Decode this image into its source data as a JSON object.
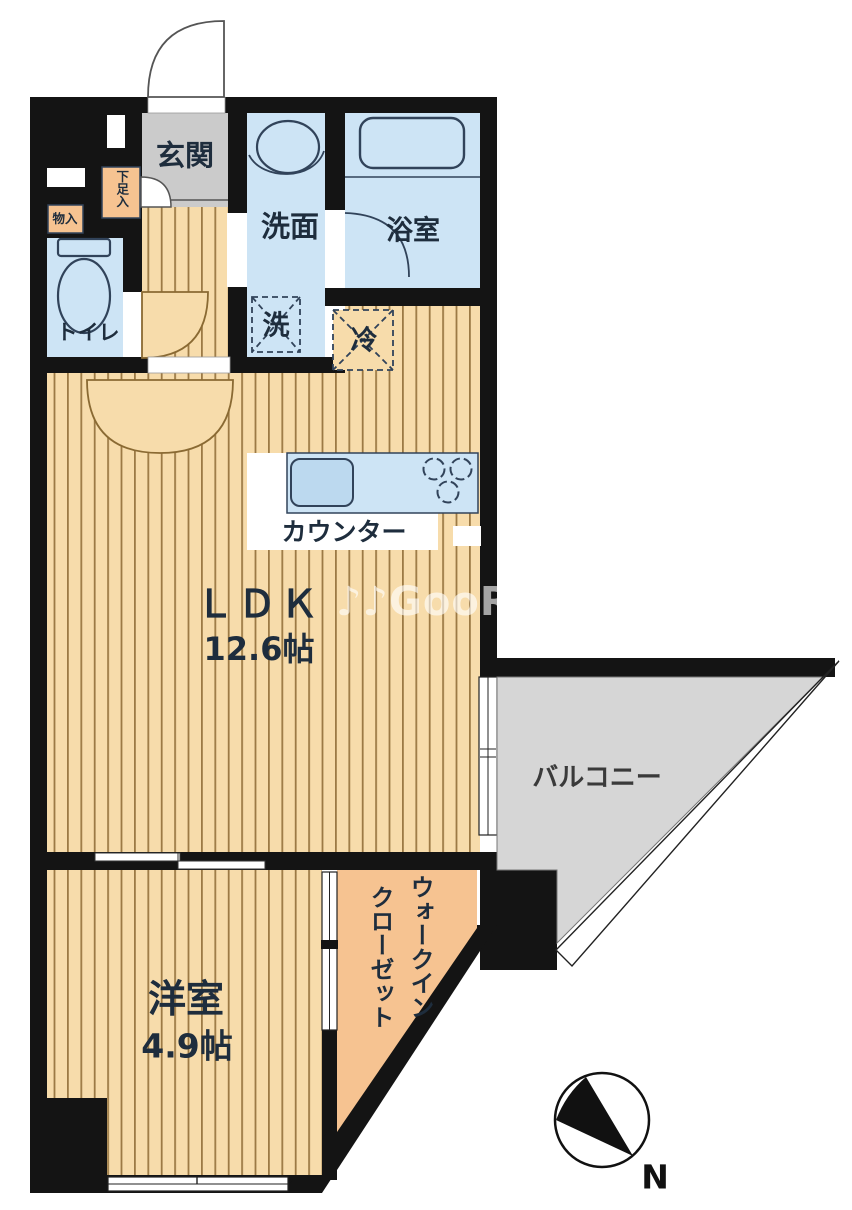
{
  "plan": {
    "rooms": {
      "genkan": {
        "label": "玄関"
      },
      "shoe_storage": {
        "label": "下足入"
      },
      "storage": {
        "label": "物入"
      },
      "toilet": {
        "label": "トイレ"
      },
      "washroom": {
        "label": "洗面"
      },
      "bathroom": {
        "label": "浴室"
      },
      "laundry_space": {
        "label": "洗"
      },
      "fridge_space": {
        "label": "冷"
      },
      "counter": {
        "label": "カウンター"
      },
      "ldk": {
        "label": "ＬＤＫ",
        "size": "12.6帖"
      },
      "balcony": {
        "label": "バルコニー"
      },
      "western_room": {
        "label": "洋室",
        "size": "4.9帖"
      },
      "walk_in_closet": {
        "label_line1": "ウォークイン",
        "label_line2": "クローゼット"
      }
    },
    "compass": {
      "label": "N"
    },
    "watermark": "♪♪GooRooM",
    "colors": {
      "wall": "#141414",
      "floor": "#f7dcab",
      "floor_stripe": "#9c7a45",
      "water_blue": "#cde4f5",
      "closet_peach": "#f6c391",
      "balcony_gray": "#d6d6d6",
      "genkan_gray": "#cbcbcb",
      "ink": "#1e2d3d"
    }
  }
}
